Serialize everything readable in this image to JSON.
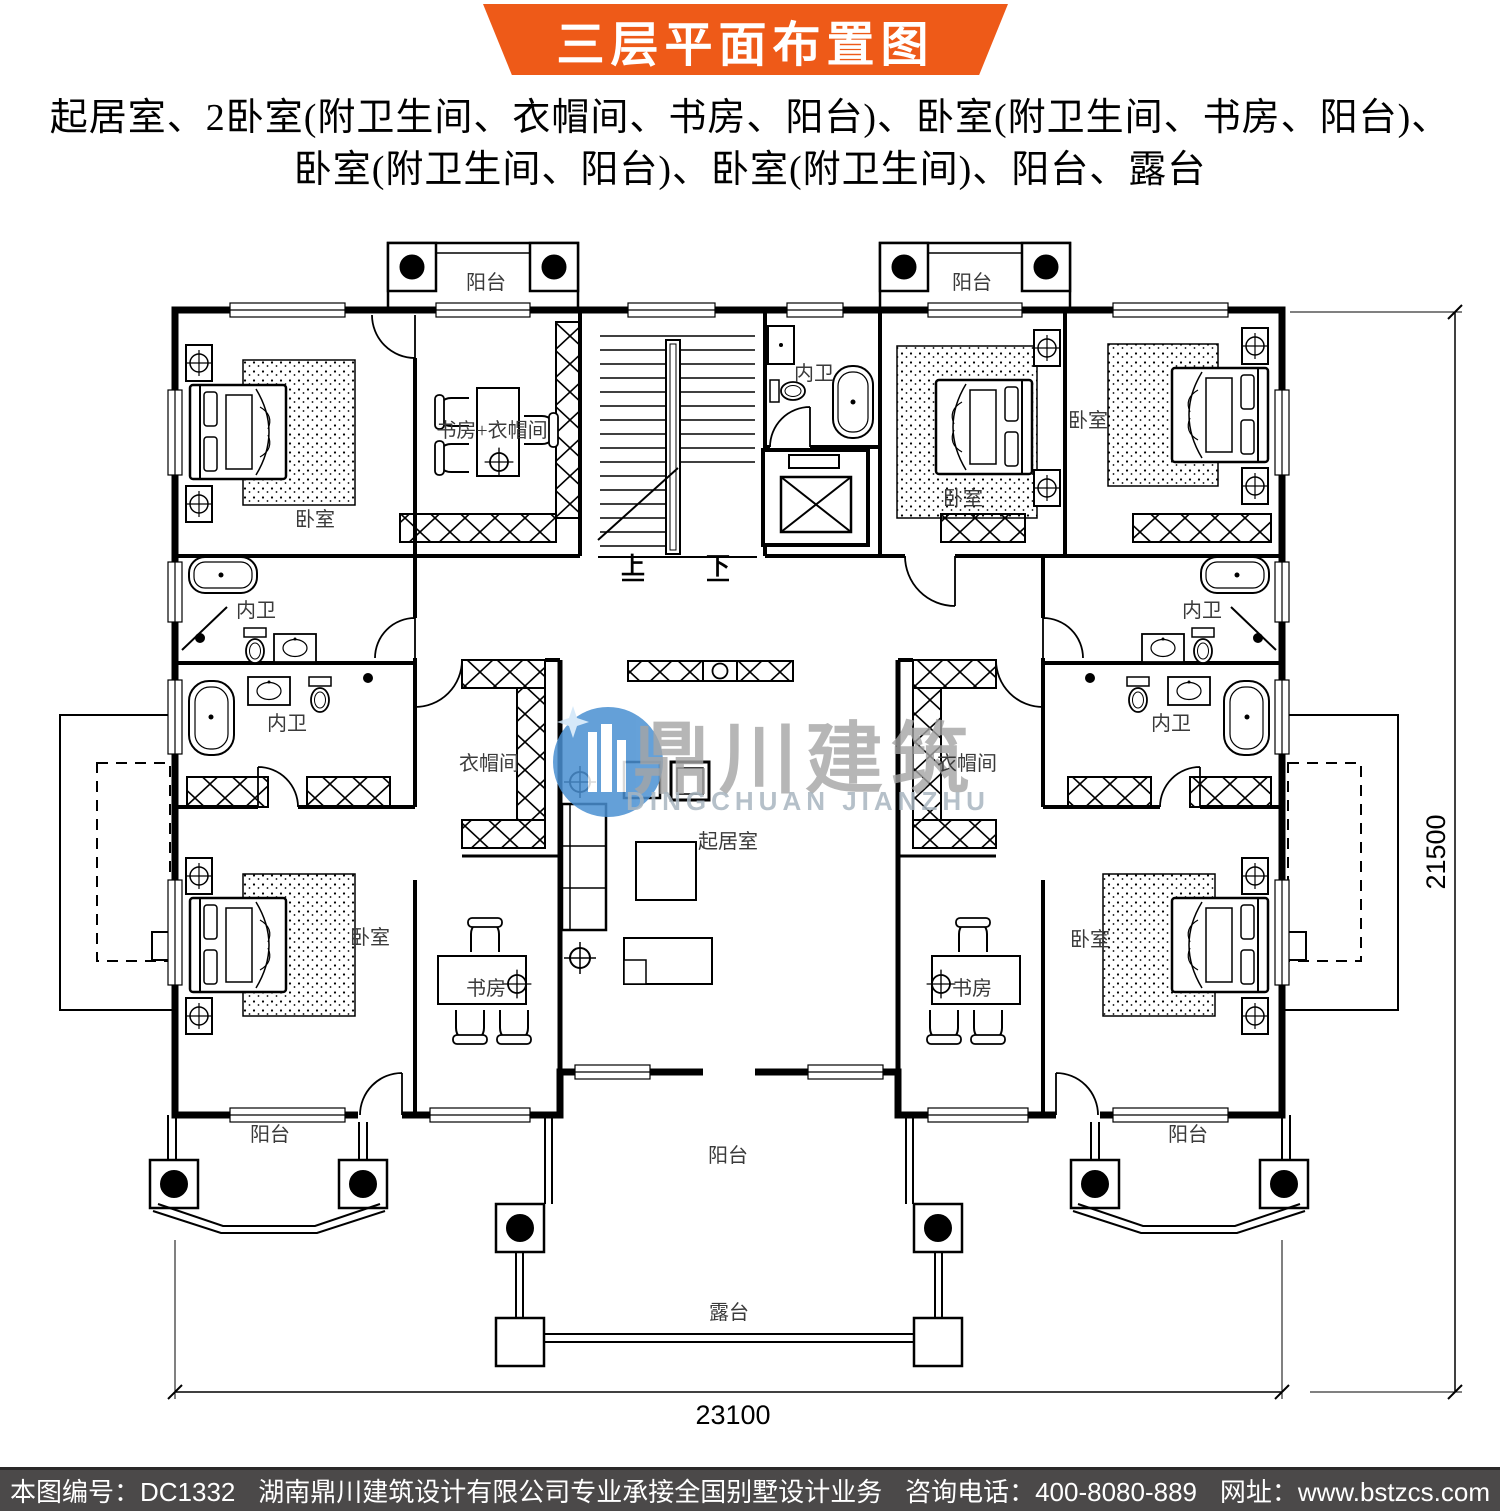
{
  "banner": {
    "title": "三层平面布置图"
  },
  "description": {
    "line1": "起居室、2卧室(附卫生间、衣帽间、书房、阳台)、卧室(附卫生间、书房、阳台)、",
    "line2": "卧室(附卫生间、阳台)、卧室(附卫生间)、阳台、露台"
  },
  "watermark": {
    "name_cn": "鼎川建筑",
    "name_en": "DINGCHUAN JIANZHU"
  },
  "dimensions": {
    "height_label": "21500",
    "width_label": "23100"
  },
  "plan": {
    "labels": [
      {
        "id": "balcony-top-left",
        "text": "阳台",
        "x": 486,
        "y": 289
      },
      {
        "id": "balcony-top-right",
        "text": "阳台",
        "x": 972,
        "y": 289
      },
      {
        "id": "bedroom-top-left",
        "text": "卧室",
        "x": 315,
        "y": 526
      },
      {
        "id": "study-cloak-top-left",
        "text": "书房+衣帽间",
        "x": 492,
        "y": 437
      },
      {
        "id": "bath-top-center",
        "text": "内卫",
        "x": 814,
        "y": 380
      },
      {
        "id": "bedroom-top-center-right",
        "text": "卧室",
        "x": 963,
        "y": 505
      },
      {
        "id": "bedroom-top-right",
        "text": "卧室",
        "x": 1088,
        "y": 427
      },
      {
        "id": "stairs-up",
        "text": "上",
        "x": 633,
        "y": 574,
        "cls": "big"
      },
      {
        "id": "stairs-down",
        "text": "下",
        "x": 718,
        "y": 574,
        "cls": "big"
      },
      {
        "id": "bath-left-upper",
        "text": "内卫",
        "x": 256,
        "y": 617
      },
      {
        "id": "bath-left-lower",
        "text": "内卫",
        "x": 287,
        "y": 730
      },
      {
        "id": "bath-right-upper",
        "text": "内卫",
        "x": 1202,
        "y": 617
      },
      {
        "id": "bath-right-lower",
        "text": "内卫",
        "x": 1171,
        "y": 730
      },
      {
        "id": "cloakroom-left",
        "text": "衣帽间",
        "x": 489,
        "y": 770
      },
      {
        "id": "cloakroom-right",
        "text": "衣帽间",
        "x": 967,
        "y": 770
      },
      {
        "id": "living-room",
        "text": "起居室",
        "x": 728,
        "y": 848
      },
      {
        "id": "bedroom-bottom-left",
        "text": "卧室",
        "x": 370,
        "y": 944
      },
      {
        "id": "study-bottom-left",
        "text": "书房",
        "x": 486,
        "y": 995
      },
      {
        "id": "study-bottom-right",
        "text": "书房",
        "x": 972,
        "y": 995
      },
      {
        "id": "bedroom-bottom-right",
        "text": "卧室",
        "x": 1090,
        "y": 946
      },
      {
        "id": "balcony-bottom-left",
        "text": "阳台",
        "x": 270,
        "y": 1141
      },
      {
        "id": "balcony-bottom-center",
        "text": "阳台",
        "x": 728,
        "y": 1162
      },
      {
        "id": "balcony-bottom-right",
        "text": "阳台",
        "x": 1188,
        "y": 1141
      },
      {
        "id": "terrace",
        "text": "露台",
        "x": 729,
        "y": 1319
      }
    ]
  },
  "footer": {
    "drawing_no": "本图编号：DC1332",
    "company": "湖南鼎川建筑设计有限公司专业承接全国别墅设计业务",
    "phone": "咨询电话：400-8080-889",
    "website": "网址：www.bstzcs.com"
  },
  "colors": {
    "banner_bg": "#EE5A18",
    "footer_bg": "#4B4949",
    "watermark_blue": "#4A90D2",
    "watermark_gray": "#A5A5A5",
    "line": "#000000"
  }
}
